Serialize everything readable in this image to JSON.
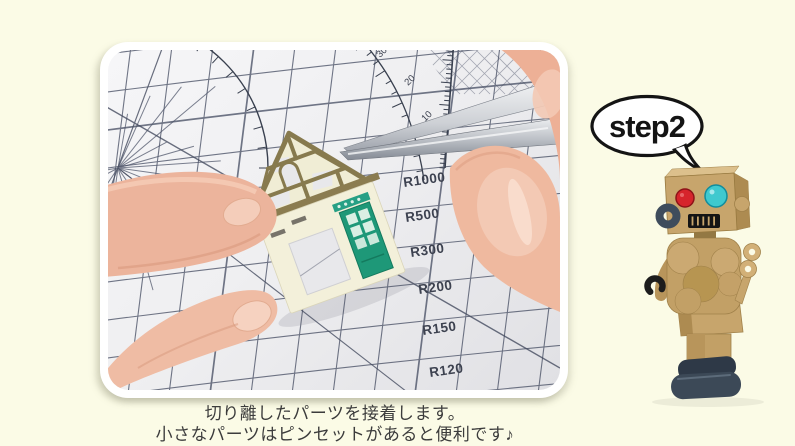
{
  "step_bubble": {
    "label": "step2"
  },
  "caption": {
    "line1": "切り離したパーツを接着します。",
    "line2": "小さなパーツはピンセットがあると便利です♪"
  },
  "photo": {
    "mat_labels": [
      "R1000",
      "R500",
      "R300",
      "R200",
      "R150",
      "R120"
    ],
    "ruler_numbers": [
      "30",
      "20",
      "10"
    ]
  },
  "colors": {
    "background": "#FBFBE6",
    "bubble_border": "#141414",
    "mat_grid_line": "#4A5166",
    "house_wall": "#F3F0DA",
    "house_timber": "#877A4E",
    "house_door": "#27A085",
    "robot_cardboard": "#C7A56C",
    "robot_eye_left": "#D6242C",
    "robot_eye_right": "#3FC9CF",
    "robot_feet": "#3C4957",
    "skin": "#ECB49C"
  }
}
